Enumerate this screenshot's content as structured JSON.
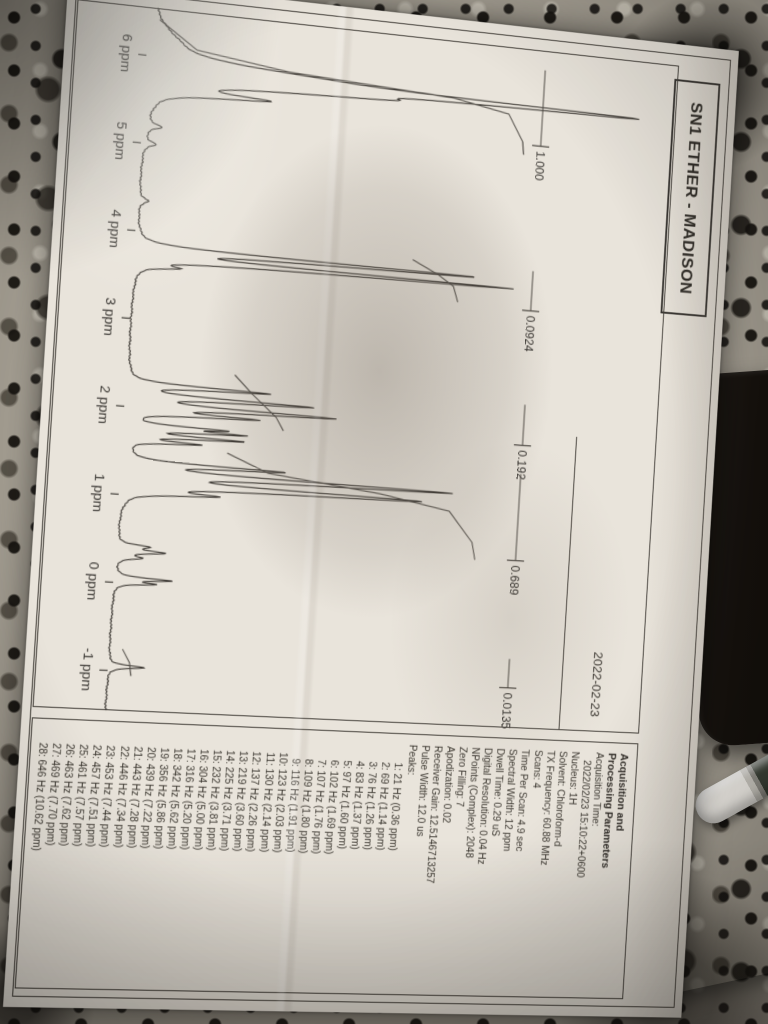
{
  "page": {
    "title": "SN1 ETHER - MADISON",
    "date": "2022-02-23",
    "axis": {
      "unit": "ppm",
      "labels": [
        "6 ppm",
        "5 ppm",
        "4 ppm",
        "3 ppm",
        "2 ppm",
        "1 ppm",
        "0 ppm",
        "-1 ppm"
      ]
    },
    "sidebar": {
      "title_lines": [
        "Acquisition and",
        "Processing Parameters"
      ],
      "params": [
        "Acquisition Time:",
        "   2022/02/23 15:10:22+0600",
        "Nucleus: 1H",
        "Solvent: Chloroform-d",
        "TX Frequency: 60.88 MHz",
        "Scans: 4",
        "Time Per Scan: 4.9 sec",
        "Spectral Width: 12 ppm",
        "Dwell Time: 0.29 uS",
        "Digital Resolution: 0.04 Hz",
        "NPoints (Complex): 2048",
        "Zero Filling: 7",
        "Apodization: 0.02",
        "Receiver Gain: 12.5146713257",
        "Pulse Width: 12.0 us"
      ],
      "peaks_heading": "Peaks:",
      "peaks": [
        "1: 21 Hz (0.36 ppm)",
        "2: 69 Hz (1.14 ppm)",
        "3: 76 Hz (1.26 ppm)",
        "4: 83 Hz (1.37 ppm)",
        "5: 97 Hz (1.60 ppm)",
        "6: 102 Hz (1.69 ppm)",
        "7: 107 Hz (1.76 ppm)",
        "8: 109 Hz (1.80 ppm)",
        "9: 116 Hz (1.91 ppm)",
        "10: 123 Hz (2.03 ppm)",
        "11: 130 Hz (2.14 ppm)",
        "12: 137 Hz (2.26 ppm)",
        "13: 219 Hz (3.60 ppm)",
        "14: 225 Hz (3.71 ppm)",
        "15: 232 Hz (3.81 ppm)",
        "16: 304 Hz (5.00 ppm)",
        "17: 316 Hz (5.20 ppm)",
        "18: 342 Hz (5.62 ppm)",
        "19: 356 Hz (5.86 ppm)",
        "20: 439 Hz (7.22 ppm)",
        "21: 443 Hz (7.28 ppm)",
        "22: 446 Hz (7.34 ppm)",
        "23: 453 Hz (7.44 ppm)",
        "24: 457 Hz (7.51 ppm)",
        "25: 461 Hz (7.57 ppm)",
        "26: 463 Hz (7.62 ppm)",
        "27: 469 Hz (7.70 ppm)",
        "28: 646 Hz (10.62 ppm)"
      ]
    }
  },
  "chart_data": {
    "type": "line",
    "title": "SN1 ETHER - MADISON 1H NMR spectrum",
    "xlabel": "ppm",
    "x_range": [
      6.55,
      -1.45
    ],
    "x_ticks": [
      6,
      5,
      4,
      3,
      2,
      1,
      0,
      -1
    ],
    "grid": false,
    "peaks": [
      [
        6.18,
        0.035,
        0.22
      ],
      [
        5.93,
        0.22,
        0.075
      ],
      [
        5.86,
        0.72,
        0.028
      ],
      [
        5.78,
        0.32,
        0.045
      ],
      [
        5.62,
        0.18,
        0.032
      ],
      [
        5.2,
        0.028,
        0.03
      ],
      [
        5.0,
        0.022,
        0.03
      ],
      [
        4.35,
        0.016,
        0.035
      ],
      [
        3.81,
        0.62,
        0.018
      ],
      [
        3.71,
        0.68,
        0.018
      ],
      [
        3.61,
        0.06,
        0.02
      ],
      [
        2.26,
        0.25,
        0.02
      ],
      [
        2.14,
        0.32,
        0.02
      ],
      [
        2.03,
        0.36,
        0.022
      ],
      [
        1.95,
        0.21,
        0.018
      ],
      [
        1.8,
        0.155,
        0.016
      ],
      [
        1.76,
        0.185,
        0.015
      ],
      [
        1.69,
        0.2,
        0.016
      ],
      [
        1.62,
        0.125,
        0.016
      ],
      [
        1.37,
        0.27,
        0.02
      ],
      [
        1.26,
        0.58,
        0.022
      ],
      [
        1.14,
        0.53,
        0.026
      ],
      [
        1.04,
        0.14,
        0.022
      ],
      [
        0.42,
        0.05,
        0.022
      ],
      [
        0.36,
        0.08,
        0.022
      ],
      [
        0.29,
        0.04,
        0.02
      ],
      [
        0.05,
        0.1,
        0.018
      ],
      [
        0.0,
        0.065,
        0.016
      ],
      [
        -0.95,
        0.065,
        0.02
      ]
    ],
    "integral_labels": [
      {
        "value": "1.000",
        "ppm_from": 6.32,
        "ppm_to": 5.42
      },
      {
        "value": "0.0924",
        "ppm_from": 3.94,
        "ppm_to": 3.47
      },
      {
        "value": "0.192",
        "ppm_from": 2.36,
        "ppm_to": 1.88
      },
      {
        "value": "0.689",
        "ppm_from": 1.54,
        "ppm_to": 0.52
      },
      {
        "value": "0.0135",
        "ppm_from": -0.64,
        "ppm_to": -0.98
      }
    ],
    "integral_traces": [
      [
        [
          6.42,
          0.02
        ],
        [
          6.12,
          0.09
        ],
        [
          5.98,
          0.26
        ],
        [
          5.88,
          0.57
        ],
        [
          5.76,
          0.675
        ],
        [
          5.45,
          0.705
        ],
        [
          5.3,
          0.708
        ]
      ],
      [
        [
          3.95,
          0.51
        ],
        [
          3.8,
          0.56
        ],
        [
          3.68,
          0.59
        ],
        [
          3.5,
          0.6
        ]
      ],
      [
        [
          2.45,
          0.195
        ],
        [
          2.25,
          0.228
        ],
        [
          2.0,
          0.275
        ],
        [
          1.85,
          0.29
        ]
      ],
      [
        [
          1.55,
          0.19
        ],
        [
          1.35,
          0.267
        ],
        [
          1.2,
          0.476
        ],
        [
          1.05,
          0.608
        ],
        [
          0.7,
          0.655
        ],
        [
          0.5,
          0.662
        ]
      ],
      [
        [
          -0.75,
          0.024
        ],
        [
          -0.9,
          0.038
        ],
        [
          -1.05,
          0.042
        ]
      ]
    ]
  },
  "colors": {
    "paper": "#e9e4db",
    "ink": "#39352f",
    "border": "#45413b",
    "granite_base": "#a39d91",
    "phone": "#15110d",
    "pink_box": "#c18a71",
    "stylus_body": "#f0ede7"
  }
}
